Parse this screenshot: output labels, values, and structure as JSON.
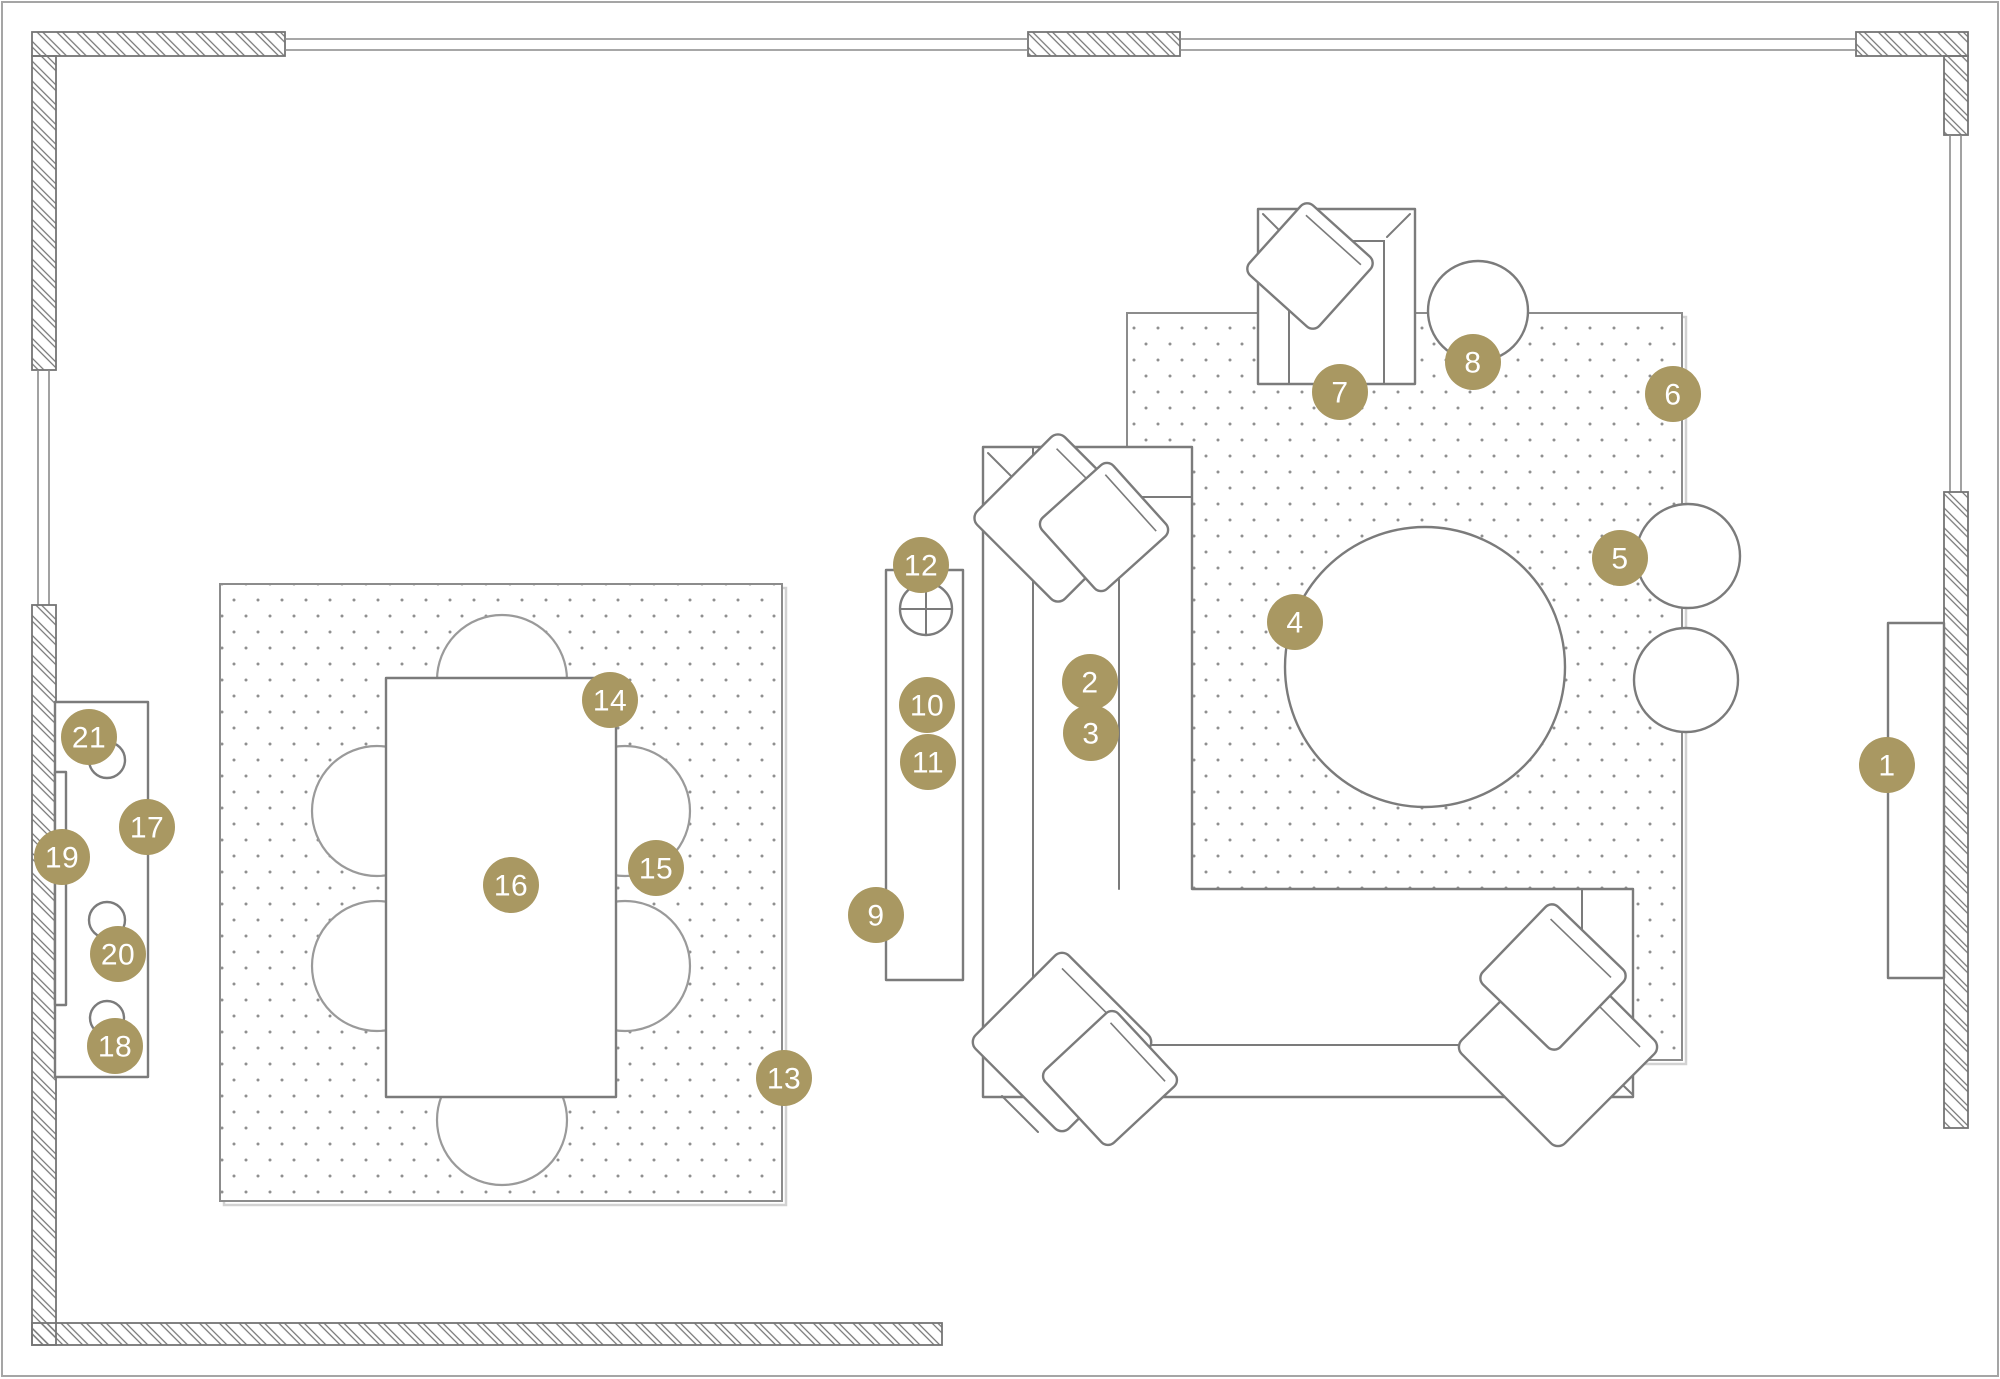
{
  "view": {
    "type": "floor-plan",
    "description": "Top-down furniture floor plan with numbered item markers"
  },
  "colors": {
    "background": "#ffffff",
    "marker_fill": "#a99862",
    "marker_text": "#ffffff",
    "furniture_line": "#7b7b7b",
    "wall_line": "#757575",
    "chair_line": "#9a9a9a",
    "rug_line": "#8c8c8c",
    "rug_dot": "#8f8f8f",
    "window_line": "#8a8a8a",
    "frame_line": "#a5a5a5"
  },
  "marker_radius": 28,
  "markers": [
    {
      "label": "1",
      "x": 1887,
      "y": 765
    },
    {
      "label": "2",
      "x": 1090,
      "y": 682
    },
    {
      "label": "3",
      "x": 1091,
      "y": 733
    },
    {
      "label": "4",
      "x": 1295,
      "y": 622
    },
    {
      "label": "5",
      "x": 1620,
      "y": 558
    },
    {
      "label": "6",
      "x": 1673,
      "y": 394
    },
    {
      "label": "7",
      "x": 1340,
      "y": 392
    },
    {
      "label": "8",
      "x": 1473,
      "y": 362
    },
    {
      "label": "9",
      "x": 876,
      "y": 915
    },
    {
      "label": "10",
      "x": 927,
      "y": 705
    },
    {
      "label": "11",
      "x": 928,
      "y": 762
    },
    {
      "label": "12",
      "x": 921,
      "y": 565
    },
    {
      "label": "13",
      "x": 784,
      "y": 1078
    },
    {
      "label": "14",
      "x": 610,
      "y": 700
    },
    {
      "label": "15",
      "x": 656,
      "y": 868
    },
    {
      "label": "16",
      "x": 511,
      "y": 885
    },
    {
      "label": "17",
      "x": 147,
      "y": 827
    },
    {
      "label": "18",
      "x": 115,
      "y": 1046
    },
    {
      "label": "19",
      "x": 62,
      "y": 857
    },
    {
      "label": "20",
      "x": 118,
      "y": 954
    },
    {
      "label": "21",
      "x": 89,
      "y": 737
    }
  ]
}
